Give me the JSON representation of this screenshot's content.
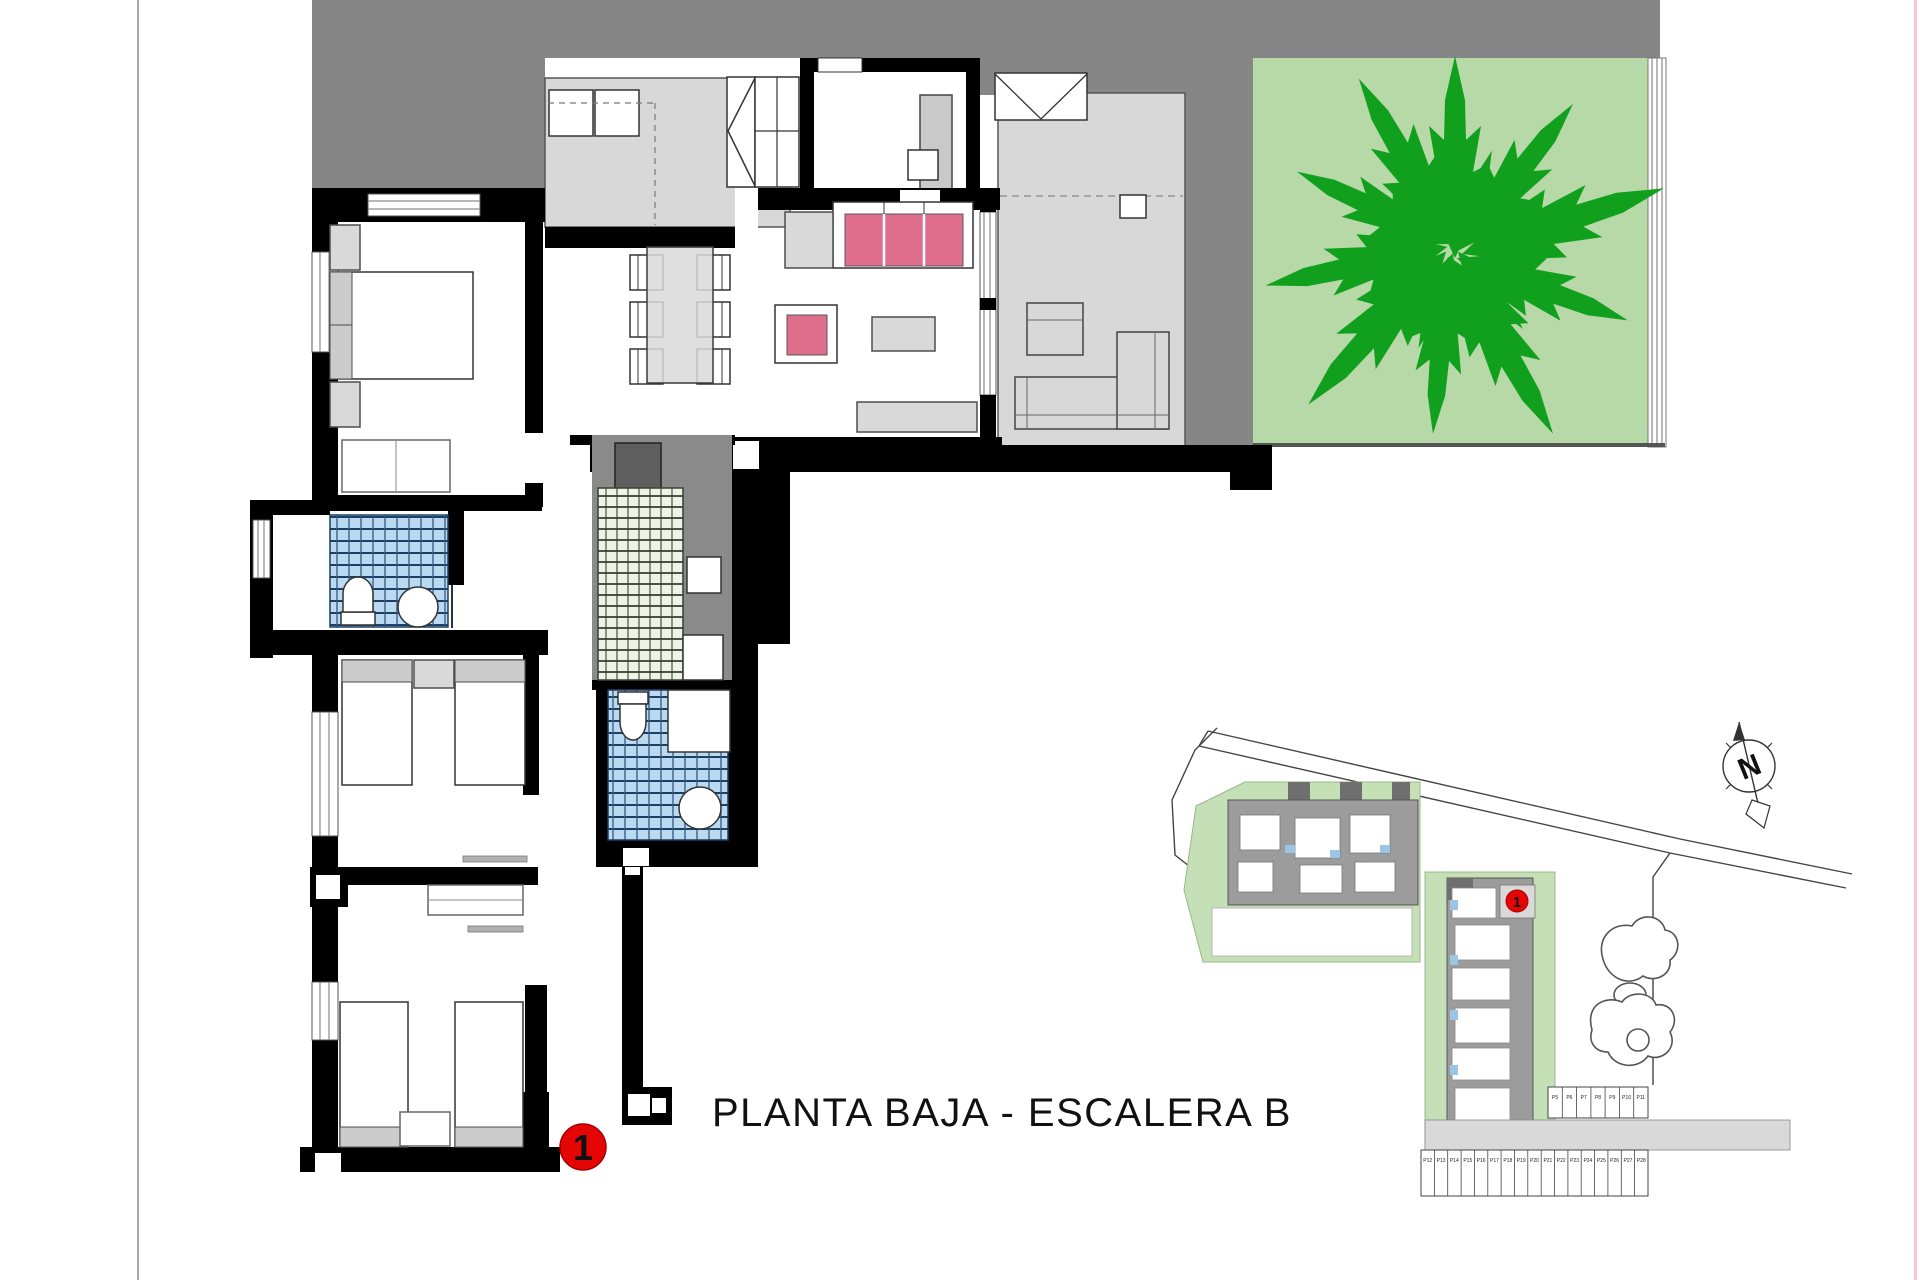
{
  "title": {
    "text": "PLANTA BAJA - ESCALERA B"
  },
  "floor_plan": {
    "unit_marker": "1"
  },
  "site_plan": {
    "unit_marker": "1",
    "compass_letter": "N",
    "parking_bottom": [
      "P12",
      "P13",
      "P14",
      "P15",
      "P16",
      "P17",
      "P18",
      "P19",
      "P20",
      "P21",
      "P22",
      "P23",
      "P24",
      "P25",
      "P26",
      "P27",
      "P28"
    ],
    "parking_right": [
      "P5",
      "P6",
      "P7",
      "P8",
      "P9",
      "P10",
      "P11"
    ]
  },
  "colors": {
    "wall_black": "#000000",
    "deck_gray": "#868686",
    "terrace_gray": "#d8d8d8",
    "garden_green": "#b6d9a7",
    "plant_green": "#10a01e",
    "sofa_pink": "#df6e8d",
    "tile_blue": "#bcd9f2",
    "tile_green": "#edf3e7",
    "site_green": "#c5dfb6",
    "marker_red": "#e60505"
  }
}
